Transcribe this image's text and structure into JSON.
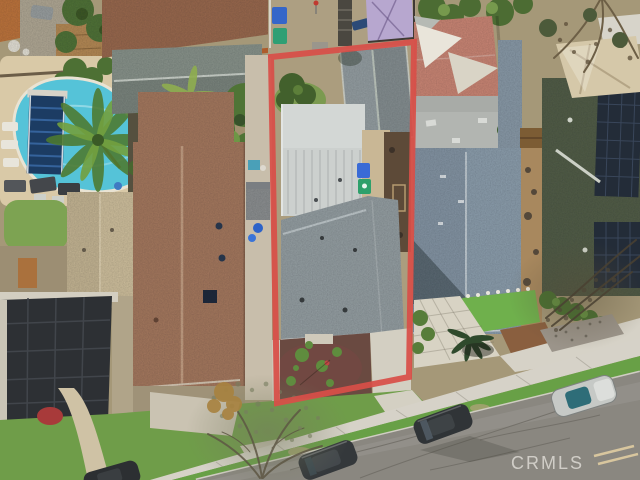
{
  "watermark": {
    "label": "CRMLS"
  },
  "annotation": {
    "property_outline_color": "#d84f48"
  },
  "palette": {
    "pool_water": "#55c3d8",
    "pool_cover": "#1c3c63",
    "asphalt": "#8a8780",
    "sidewalk_concrete": "#d6d2c8",
    "lawn_green": "#6f9d49",
    "brown_shingle_roof": "#a77a62",
    "gray_shingle_roof": "#97a1a6",
    "blue_gray_roof": "#8ea0b0",
    "solar_panel": "#232c38",
    "pink_roof": "#cd8878",
    "purple_tarp": "#b7a7cf",
    "mulch_bed": "#6a4a41"
  },
  "scene_features": [
    "swimming-pool",
    "pool-cover-roller",
    "palm-tree",
    "outlined-property-boundary",
    "flat-roof-house",
    "gable-roofs",
    "solar-panels",
    "shade-sails",
    "tarp-canopy",
    "street-with-parked-cars",
    "sidewalk",
    "front-yard-mulch-garden",
    "trash-bins",
    "bare-trees"
  ]
}
